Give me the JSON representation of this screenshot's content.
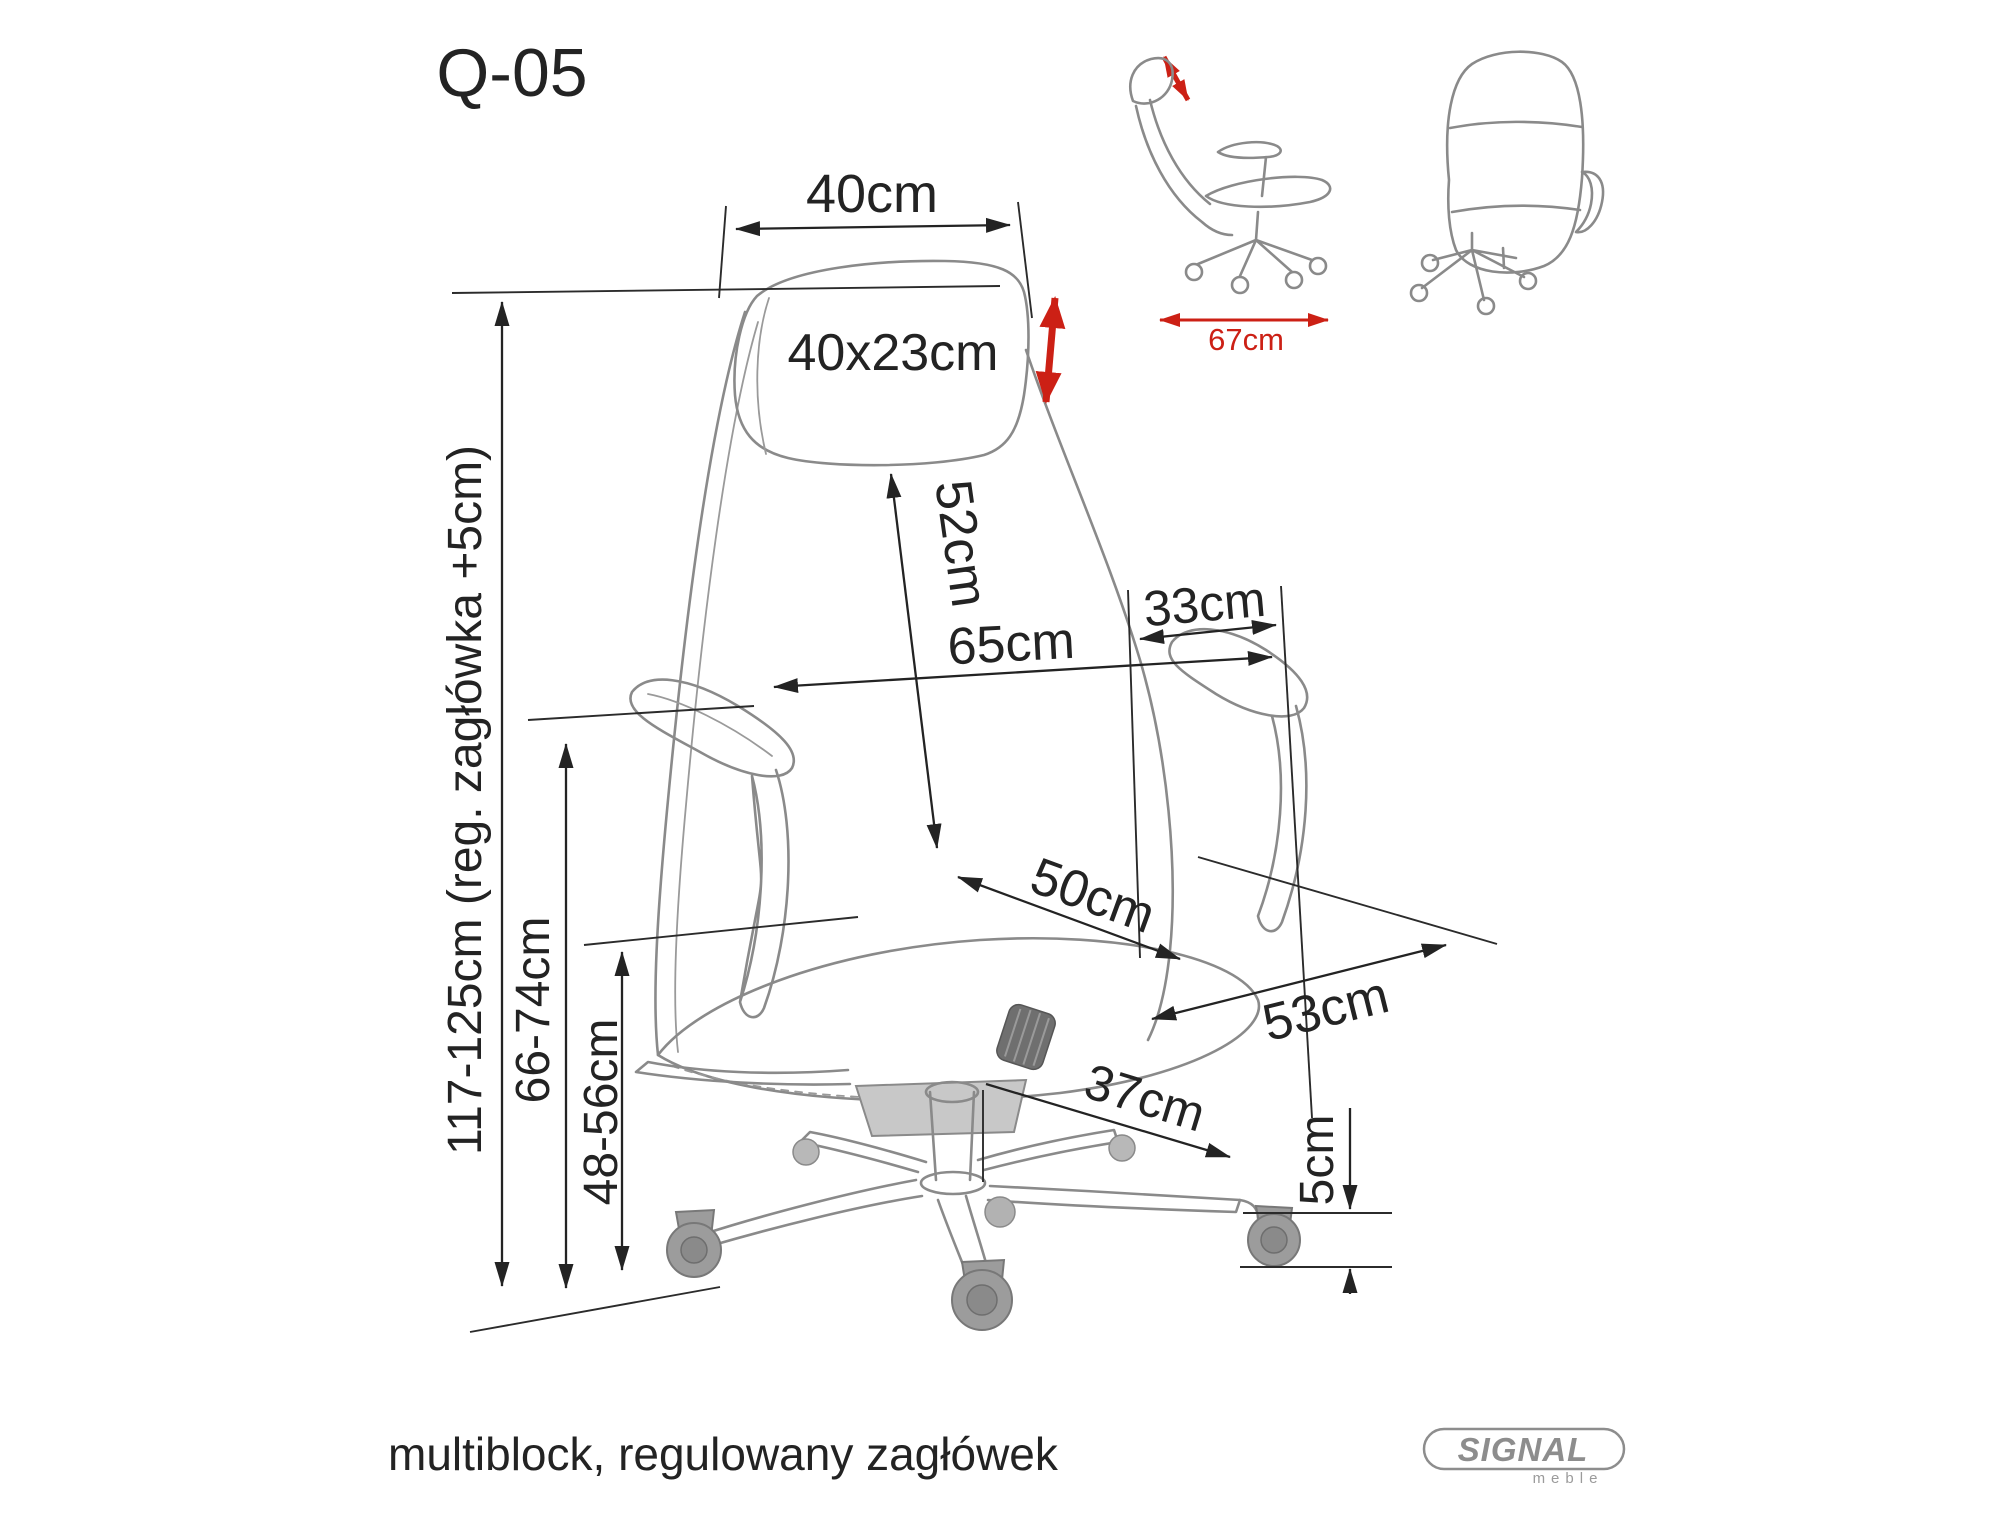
{
  "title": "Q-05",
  "footer_note": "multiblock, regulowany zagłówek",
  "logo": {
    "brand": "SIGNAL",
    "sub": "meble"
  },
  "dims": {
    "headrest_width": "40cm",
    "headrest_size": "40x23cm",
    "backrest_diagonal": "52cm",
    "backrest_width": "65cm",
    "armrest_depth": "33cm",
    "seat_depth": "50cm",
    "seat_width": "53cm",
    "base_leg_length": "37cm",
    "caster_height": "5cm",
    "seat_height_range": "48-56cm",
    "armrest_height_range": "66-74cm",
    "total_height_range": "117-125cm (reg. zagłówka +5cm)",
    "overall_depth": "67cm"
  },
  "colors": {
    "dimension_line": "#232323",
    "accent_red": "#cc2015",
    "drawing_gray": "#8a8a8a"
  }
}
